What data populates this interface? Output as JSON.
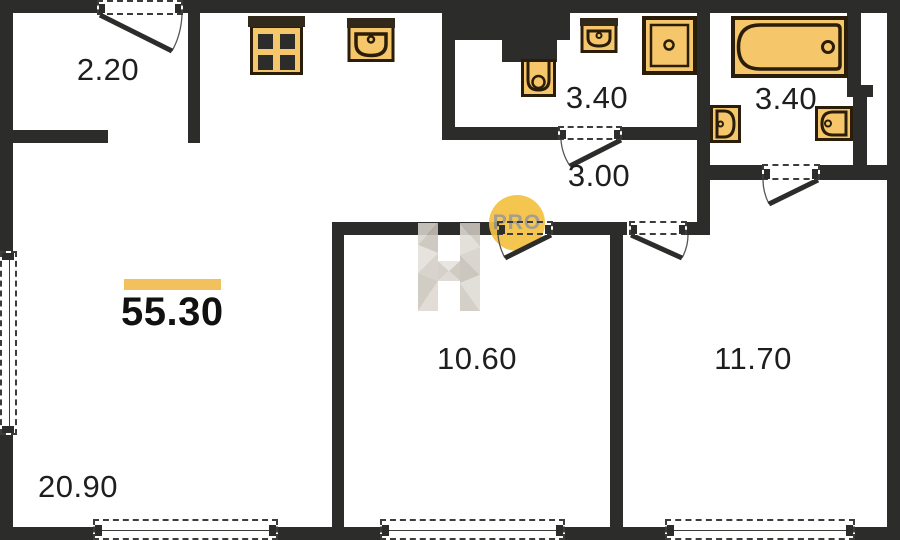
{
  "total": {
    "area": "55.30"
  },
  "rooms": [
    {
      "name": "entry-hall",
      "area": "2.20"
    },
    {
      "name": "bathroom-1",
      "area": "3.40"
    },
    {
      "name": "bathroom-2",
      "area": "3.40"
    },
    {
      "name": "hallway",
      "area": "3.00"
    },
    {
      "name": "room-1",
      "area": "10.60"
    },
    {
      "name": "room-2",
      "area": "11.70"
    },
    {
      "name": "living-kitchen",
      "area": "20.90"
    }
  ],
  "watermark": {
    "badge": "PRO"
  },
  "fixtures": [
    "stove-icon",
    "kitchen-sink-icon",
    "wall-toilet-icon",
    "washbasin-icon",
    "shower-icon",
    "bathtub-icon",
    "toilet-icon",
    "washbasin-icon"
  ],
  "colors": {
    "wall": "#2c2c2a",
    "fixture_fill": "#f6c76a",
    "fixture_stroke": "#2a1d09",
    "accent_bar": "#f2c05c",
    "badge_fill": "#f4c243",
    "badge_text": "#9d968a",
    "label_text": "#1e1e1e"
  }
}
